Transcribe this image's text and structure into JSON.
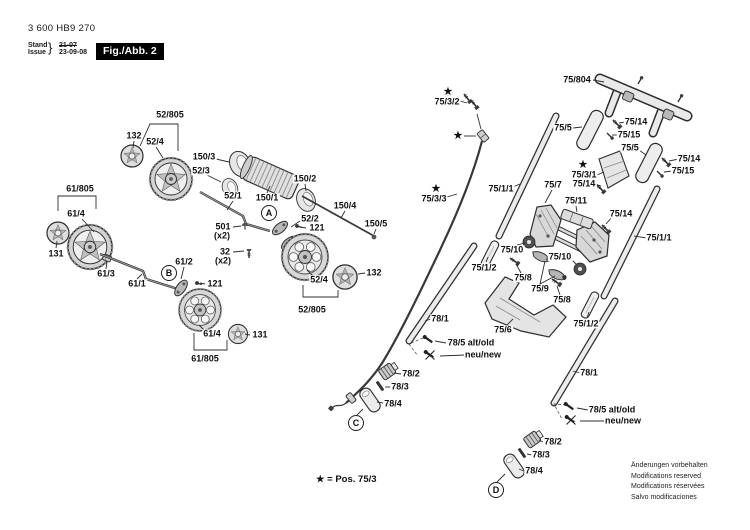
{
  "header": {
    "part_number": "3 600 HB9 270",
    "stand_label": "Stand",
    "issue_label": "Issue",
    "brace": "}",
    "date_old": "21-07",
    "date_new": "23-09-08",
    "figure_label": "Fig./Abb. 2"
  },
  "footnote": "★ = Pos. 75/3",
  "disclaimer": [
    "Änderungen vorbehalten",
    "Modifications reserved",
    "Modifications réservées",
    "Salvo modificaciones"
  ],
  "ref_markers": [
    {
      "letter": "A",
      "x": 269,
      "y": 213
    },
    {
      "letter": "B",
      "x": 169,
      "y": 273
    },
    {
      "letter": "C",
      "x": 356,
      "y": 423
    },
    {
      "letter": "D",
      "x": 496,
      "y": 490
    }
  ],
  "stars": [
    {
      "x": 448,
      "y": 92
    },
    {
      "x": 458,
      "y": 136
    },
    {
      "x": 436,
      "y": 189
    },
    {
      "x": 583,
      "y": 165
    }
  ],
  "part_labels": [
    {
      "text": "52/805",
      "x": 170,
      "y": 115
    },
    {
      "text": "132",
      "x": 134,
      "y": 136
    },
    {
      "text": "52/4",
      "x": 155,
      "y": 142
    },
    {
      "text": "150/3",
      "x": 204,
      "y": 157
    },
    {
      "text": "52/3",
      "x": 201,
      "y": 171
    },
    {
      "text": "61/805",
      "x": 80,
      "y": 189
    },
    {
      "text": "61/4",
      "x": 76,
      "y": 214
    },
    {
      "text": "52/1",
      "x": 233,
      "y": 196
    },
    {
      "text": "150/1",
      "x": 267,
      "y": 198
    },
    {
      "text": "150/2",
      "x": 305,
      "y": 179
    },
    {
      "text": "150/4",
      "x": 345,
      "y": 206
    },
    {
      "text": "150/5",
      "x": 376,
      "y": 224
    },
    {
      "text": "501",
      "x": 223,
      "y": 227
    },
    {
      "text": "(x2)",
      "x": 222,
      "y": 236
    },
    {
      "text": "32",
      "x": 225,
      "y": 252
    },
    {
      "text": "(x2)",
      "x": 223,
      "y": 261
    },
    {
      "text": "52/2",
      "x": 310,
      "y": 219
    },
    {
      "text": "121",
      "x": 317,
      "y": 228
    },
    {
      "text": "131",
      "x": 56,
      "y": 254
    },
    {
      "text": "61/3",
      "x": 106,
      "y": 274
    },
    {
      "text": "61/1",
      "x": 137,
      "y": 284
    },
    {
      "text": "61/2",
      "x": 184,
      "y": 262
    },
    {
      "text": "121",
      "x": 215,
      "y": 284
    },
    {
      "text": "61/4",
      "x": 212,
      "y": 334
    },
    {
      "text": "131",
      "x": 260,
      "y": 335
    },
    {
      "text": "61/805",
      "x": 205,
      "y": 359
    },
    {
      "text": "52/4",
      "x": 319,
      "y": 280
    },
    {
      "text": "132",
      "x": 374,
      "y": 273
    },
    {
      "text": "52/805",
      "x": 312,
      "y": 310
    },
    {
      "text": "75/3/2",
      "x": 447,
      "y": 102
    },
    {
      "text": "75/3/3",
      "x": 434,
      "y": 199
    },
    {
      "text": "75/804",
      "x": 577,
      "y": 80
    },
    {
      "text": "75/5",
      "x": 563,
      "y": 128
    },
    {
      "text": "75/14",
      "x": 636,
      "y": 122
    },
    {
      "text": "75/15",
      "x": 629,
      "y": 135
    },
    {
      "text": "75/5",
      "x": 630,
      "y": 148
    },
    {
      "text": "75/14",
      "x": 689,
      "y": 159
    },
    {
      "text": "75/15",
      "x": 683,
      "y": 171
    },
    {
      "text": "75/3/1",
      "x": 584,
      "y": 175
    },
    {
      "text": "75/14",
      "x": 584,
      "y": 184
    },
    {
      "text": "75/7",
      "x": 553,
      "y": 185
    },
    {
      "text": "75/1/1",
      "x": 501,
      "y": 189
    },
    {
      "text": "75/11",
      "x": 576,
      "y": 201
    },
    {
      "text": "75/14",
      "x": 621,
      "y": 214
    },
    {
      "text": "75/1/1",
      "x": 659,
      "y": 238
    },
    {
      "text": "75/10",
      "x": 512,
      "y": 250
    },
    {
      "text": "75/10",
      "x": 560,
      "y": 257
    },
    {
      "text": "75/1/2",
      "x": 484,
      "y": 268
    },
    {
      "text": "75/8",
      "x": 523,
      "y": 278
    },
    {
      "text": "75/9",
      "x": 540,
      "y": 289
    },
    {
      "text": "75/8",
      "x": 562,
      "y": 300
    },
    {
      "text": "75/6",
      "x": 503,
      "y": 330
    },
    {
      "text": "75/1/2",
      "x": 586,
      "y": 324
    },
    {
      "text": "78/1",
      "x": 440,
      "y": 319
    },
    {
      "text": "78/5 alt/old",
      "x": 471,
      "y": 343
    },
    {
      "text": "neu/new",
      "x": 483,
      "y": 355
    },
    {
      "text": "78/2",
      "x": 411,
      "y": 374
    },
    {
      "text": "78/3",
      "x": 400,
      "y": 387
    },
    {
      "text": "78/4",
      "x": 393,
      "y": 404
    },
    {
      "text": "78/1",
      "x": 589,
      "y": 373
    },
    {
      "text": "78/5 alt/old",
      "x": 612,
      "y": 410
    },
    {
      "text": "neu/new",
      "x": 623,
      "y": 421
    },
    {
      "text": "78/2",
      "x": 553,
      "y": 442
    },
    {
      "text": "78/3",
      "x": 541,
      "y": 455
    },
    {
      "text": "78/4",
      "x": 534,
      "y": 471
    }
  ]
}
